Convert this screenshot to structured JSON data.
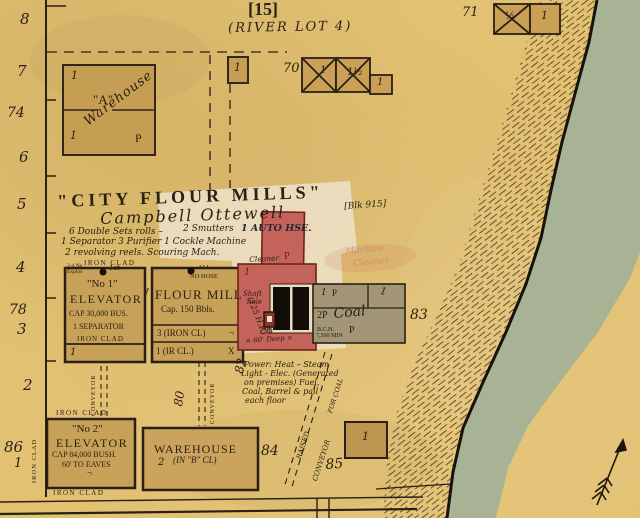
{
  "header": {
    "sheet_number": "[15]",
    "river_lot": "(RIVER LOT 4)"
  },
  "lot_numbers": {
    "n8": "8",
    "n7": "7",
    "n74": "74",
    "n6": "6",
    "n5": "5",
    "n4": "4",
    "n78": "78",
    "n3": "3",
    "n2": "2",
    "n86": "86",
    "n1": "1"
  },
  "warehouse_a": {
    "floor_top": "1",
    "letter": "\"A\"",
    "name": "Warehouse",
    "floor_bottom": "1",
    "p": "P"
  },
  "building_70": {
    "number": "70",
    "floor1": "1",
    "floor2": "1½",
    "floor3": "1"
  },
  "building_71": {
    "number": "71",
    "floor1": "½",
    "floor2": "1"
  },
  "small_box": {
    "floor": "1"
  },
  "title_block": {
    "title": "\"CITY FLOUR MILLS\"",
    "owner": "Campbell Ottewell",
    "block": "[Blk 915]",
    "note1": "6 Double Sets rolls –",
    "note1b": "2 Smutters",
    "auto_house": "1 AUTO HSE.",
    "note2": "1 Separator  3 Purifier  1 Cockle Machine",
    "note3": "2 revolving reels. Scouring Mach.",
    "cleaner": "Cleaner",
    "p": "P",
    "iron_clad": "IRON CLAD",
    "ghost1": "Machine",
    "ghost2": "Cleaner"
  },
  "elevator_1": {
    "explos1": "3-4 No",
    "explos2": "Explos",
    "first": "1st",
    "name1": "\"No 1\"",
    "name2": "ELEVATOR",
    "cap": "CAP 30,000 BUS.",
    "separator": "1 SEPARATOR",
    "iron": "IRON CLAD",
    "floor": "1",
    "passage": "1"
  },
  "flour_mill": {
    "all": "ALL",
    "no_hose": "NO HOSE",
    "name": "FLOUR MILL",
    "cap": "Cap. 150 Bbls.",
    "row1": "3 (IRON CL)",
    "row2": "1 (IR CL.)",
    "x": "X",
    "mark": "¬"
  },
  "red_mill": {
    "floor": "1",
    "shaft1": "Shaft",
    "shaft2": "hole",
    "hp": "(125 H.P.)",
    "co": "CO",
    "depth": "× 60' Deep ×",
    "number": "82",
    "p_top": "P"
  },
  "coal_shed": {
    "cell1": "1",
    "cell1p": "P",
    "cell2": "1",
    "label2p": "2P",
    "coal": "Coal",
    "p": "P",
    "bch": "B.C.H.",
    "cap": "7,500 MIN",
    "number": "83"
  },
  "power_note": {
    "l1": "Power: Heat – Steam",
    "l2": "Light - Elec. (Generated",
    "l3": "on premises) Fuel,",
    "l4": "Coal, Barrel & pail",
    "l5": "each floor"
  },
  "conveyors": {
    "left": "CONVEYOR",
    "mid": "CONVEYOR",
    "n80": "80",
    "raised": "RAISED",
    "conveyor": "CONVEYOR",
    "for_coal": "FOR COAL"
  },
  "elevator_2": {
    "name1": "\"No 2\"",
    "name2": "ELEVATOR",
    "cap": "CAP 84,000 BUSH.",
    "eaves": "60' TO EAVES",
    "iron_top": "IRON CLAD",
    "iron_bottom": "IRON CLAD",
    "iron_left": "IRON CLAD",
    "mark": "¬"
  },
  "warehouse_b": {
    "name": "WAREHOUSE",
    "floors": "2",
    "class": "(IN \"B\" CL)",
    "number": "84"
  },
  "box_85": {
    "floor": "1",
    "number": "85"
  },
  "colors": {
    "paper": "#e2c173",
    "building_fill": "#c9a055",
    "red_building": "#c4635a",
    "coal_shed": "#a39676",
    "river": "#a7b394",
    "ink": "#2a2014",
    "patch": "#ecdfc4"
  }
}
